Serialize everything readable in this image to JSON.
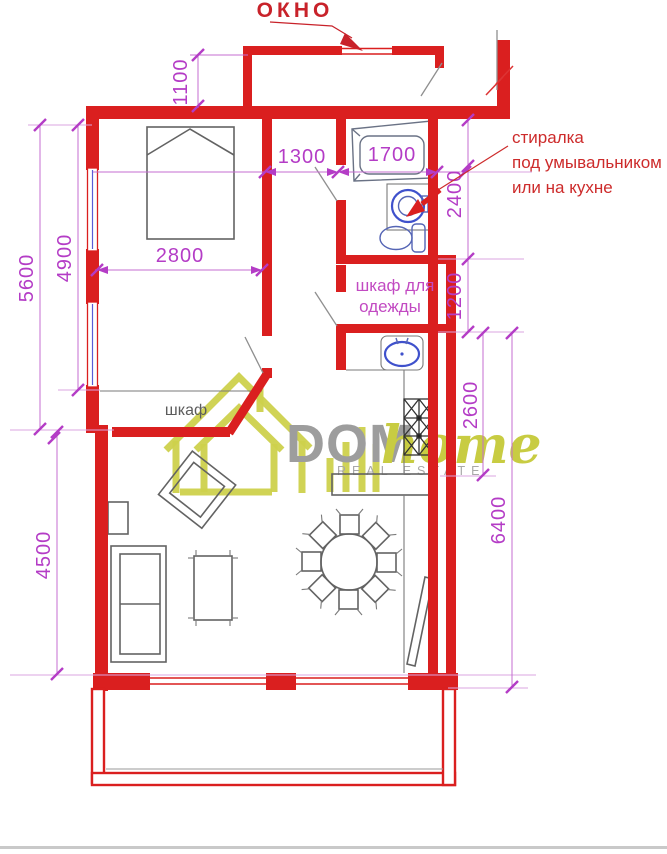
{
  "watermark": {
    "brand": "DOM",
    "brand_accent": "home",
    "tagline": "REAL ESTATE"
  },
  "labels": {
    "window": "ОКНО",
    "washer_note": [
      "стиралка",
      "под умывальником",
      "или на кухне"
    ],
    "wardrobe_note": [
      "шкаф для",
      "одежды"
    ],
    "closet": "шкаф"
  },
  "dimensions": {
    "balcony_depth": "1100",
    "hall_width": "1300",
    "bathroom_width": "1700",
    "bathroom_length": "2400",
    "bedroom_width": "2800",
    "bedroom_length": "4900",
    "left_side": "5600",
    "wardrobe_length": "1200",
    "kitchen_length": "2600",
    "right_side": "6400",
    "living_length": "4500"
  },
  "colors": {
    "wall_red": "#da1f1f",
    "dimension_magenta": "#b43cc6",
    "note_red": "#cd2b2b",
    "fixture_blue": "#3f51cc",
    "furniture_gray": "#636363",
    "logo_yellow": "#cdd14c",
    "logo_gray": "#9d9d9d"
  }
}
